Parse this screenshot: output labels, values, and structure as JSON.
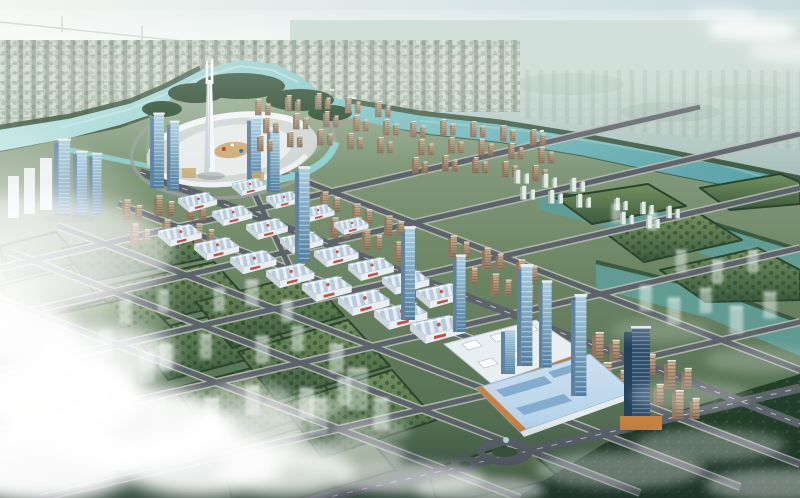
{
  "image": {
    "description": "Aerial bird's-eye architectural rendering of a planned riverside city district: a twin-spire white landmark tower on a circular plaza island inside a river loop, a diagonal avenue lined with blue-roofed exhibition halls and glass towers, a light-blue roofed convention center with orange trim, tan residential tower rows, green development parcels with translucent future buildings, teal canals, dark woods and drifting white clouds over the foreground.",
    "type": "architectural-rendering",
    "view": "aerial-perspective"
  },
  "scene": {
    "landmarks": [
      {
        "label": "twin-spire landmark tower"
      },
      {
        "label": "circular central plaza island"
      },
      {
        "label": "river"
      },
      {
        "label": "exhibition hall rows"
      },
      {
        "label": "convention center"
      },
      {
        "label": "pavilion mall"
      },
      {
        "label": "glass office towers"
      },
      {
        "label": "residential tower rows"
      },
      {
        "label": "green parcels with ghost buildings"
      },
      {
        "label": "canals and wetlands"
      },
      {
        "label": "clouds and sun glare"
      }
    ]
  },
  "palette": {
    "sky_left": "#f3f6f1",
    "sky_right": "#c0d6db",
    "haze": "#edf2ec",
    "plain_far": "#ccdcd6",
    "plain_near": "#a7c0ba",
    "citytex_bg": "#b4c2b2",
    "citytex_a": "#cfd9cc",
    "citytex_b": "#8fa190",
    "river_hi": "#b9e3e1",
    "river": "#7fc2c3",
    "river_deep": "#58a0a6",
    "water_right": "#5f9e98",
    "bank_tree": "#2f4c33",
    "forest": "#2a4a2f",
    "woods_dark": "#223d28",
    "ground_hi": "#93a98c",
    "ground_mid": "#6d8665",
    "ground_lo": "#47634a",
    "block_hi": "#74915f",
    "block_lo": "#3c5a3e",
    "hedge": "#2a452e",
    "road": "#5d636b",
    "road_casing": "#b7bcb2",
    "white_bld": "#e9eef2",
    "glass_hi": "#a9cede",
    "glass_lo": "#4f7da0",
    "glass_side": "#5d82a2",
    "tower_dark": "#2e4f6e",
    "tan_hi": "#cdb596",
    "tan_lo": "#8f7760",
    "tan_cap": "#eee6d8",
    "pale_front": "#e3ebe5",
    "pale_side": "#9fb3a6",
    "roof_blue": "#b7cbdd",
    "roof_stripe": "#e6edf3",
    "hall_front": "#e9eef3",
    "hall_side": "#cdd6dd",
    "accent_red": "#c23b2e",
    "accent_orange": "#c8813f",
    "conv_roof": "#b3d1e8",
    "skylight": "#84accf",
    "plaza_ring": "#d0d7d3",
    "plaza_inner": "#e8eceb",
    "plaza_gold": "#c9a96f",
    "ghost": "rgba(236,245,240,0.5)",
    "cloud": "#ffffff"
  }
}
